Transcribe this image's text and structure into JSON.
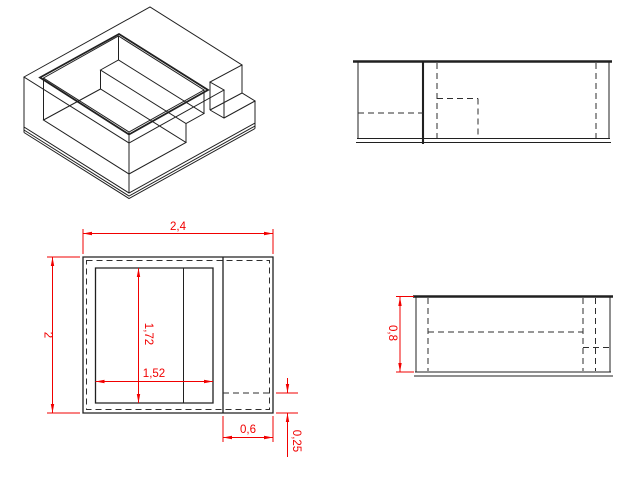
{
  "drawing": {
    "type": "multiview-technical-drawing",
    "background_color": "#ffffff",
    "edge_line_color": "#202020",
    "dimension_color": "#f10000",
    "views": {
      "isometric": {
        "description": "open box with inner step and outer corner ledge"
      },
      "rear_elevation": {
        "description": "elevation with hidden dashed lines"
      },
      "plan": {
        "dimensions": {
          "width_total": "2,4",
          "depth_total": "2",
          "cavity_depth": "1,72",
          "cavity_width": "1,52",
          "step_width": "0,6",
          "step_depth": "0,25"
        }
      },
      "side_elevation": {
        "dimensions": {
          "height_total": "0,8"
        }
      }
    }
  }
}
